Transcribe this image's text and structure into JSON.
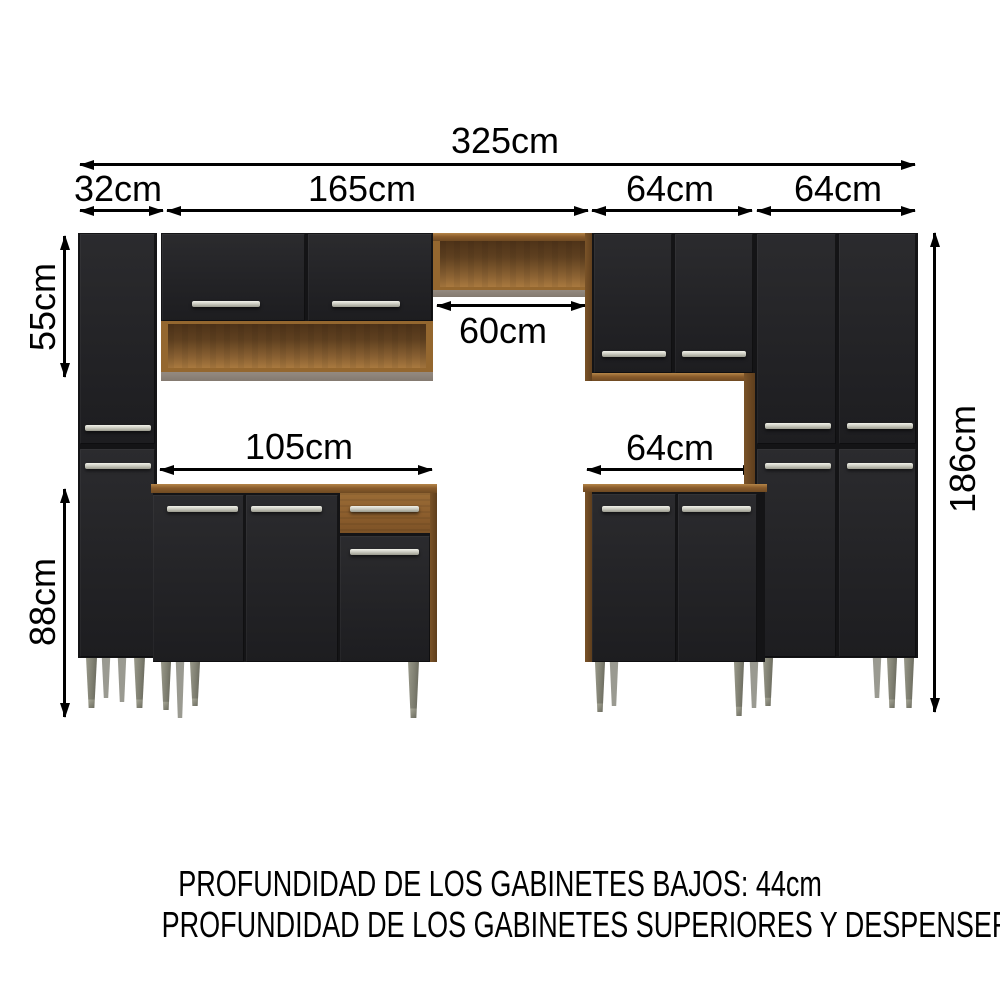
{
  "dimensions": {
    "total_width": "325cm",
    "left_cabinet_width": "32cm",
    "hutch_width": "165cm",
    "upper_right_cabinet_width": "64cm",
    "pantry_width": "64cm",
    "upper_section_height": "55cm",
    "base_section_height": "88cm",
    "total_height": "186cm",
    "stove_niche_width": "60cm",
    "base_cabinet_left_width": "105cm",
    "base_cabinet_right_width": "64cm"
  },
  "notes": {
    "line1": "PROFUNDIDAD DE LOS GABINETES BAJOS: 44cm",
    "line2": "PROFUNDIDAD DE LOS GABINETES SUPERIORES Y DESPENSEROS: 27cm"
  },
  "colors": {
    "background": "#ffffff",
    "cabinet_black": "#242427",
    "wood_medium": "#8d6132",
    "wood_light": "#a87a42",
    "wood_dark": "#6b4a28",
    "divider_gray": "#8a8078",
    "handle_metal": "#d9d9cf",
    "leg_metal": "#b5b5ab",
    "dimension_lines": "#000000"
  }
}
